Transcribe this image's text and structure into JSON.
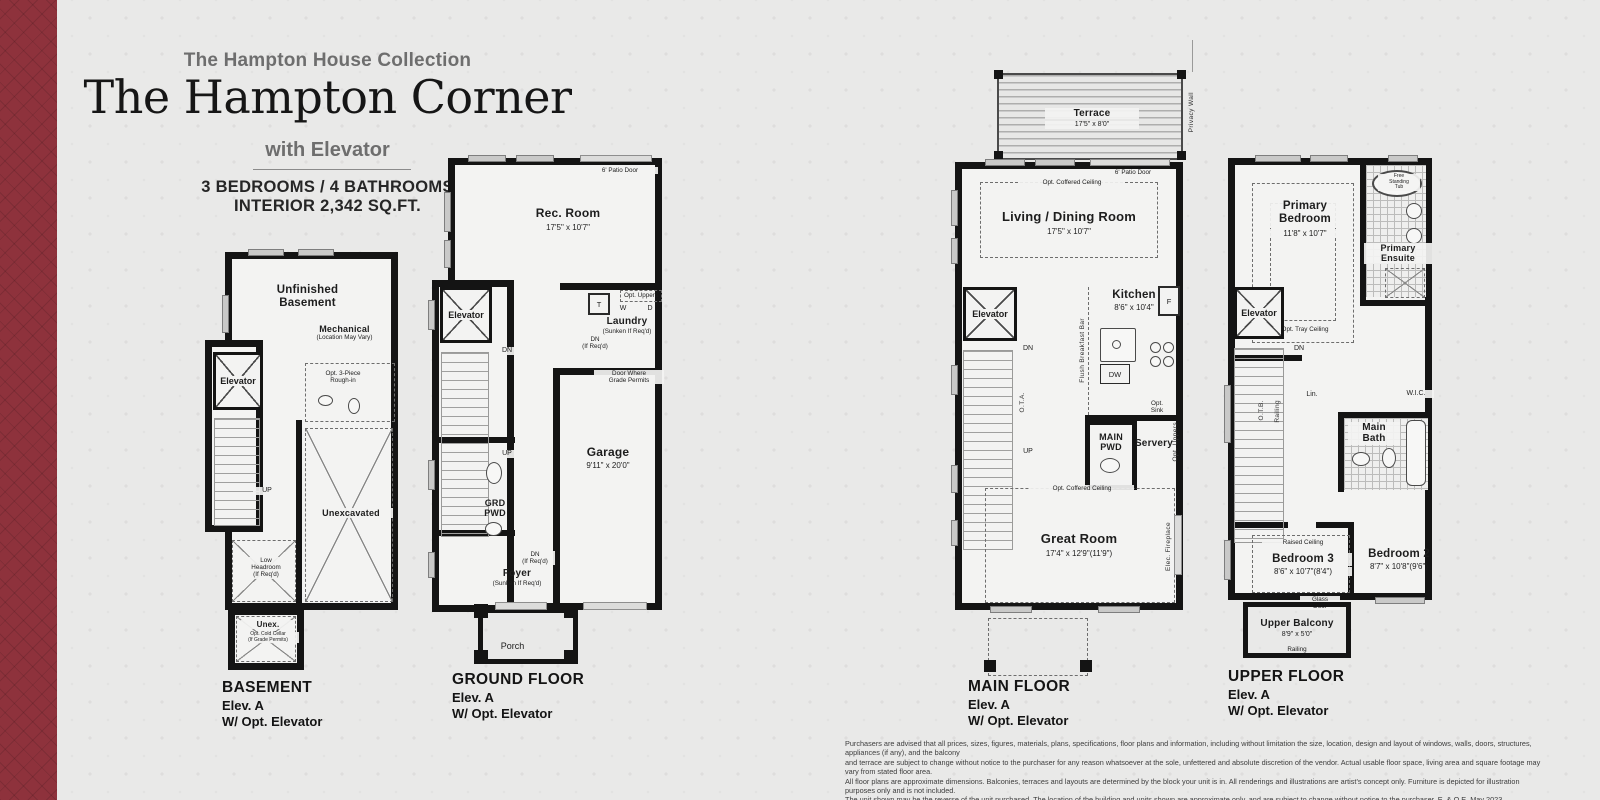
{
  "header": {
    "collection": "The Hampton House Collection",
    "title": "The Hampton Corner",
    "subtitle": "with Elevator",
    "spec1": "3 BEDROOMS / 4 BATHROOMS",
    "spec2": "INTERIOR 2,342 SQ.FT."
  },
  "basement": {
    "title": "BASEMENT",
    "elev": "Elev. A",
    "opt": "W/ Opt. Elevator",
    "unfinished": "Unfinished\nBasement",
    "mechanical": "Mechanical",
    "mechanical_note": "(Location May Vary)",
    "elevator": "Elevator",
    "rough_in": "Opt. 3-Piece\nRough-in",
    "up": "UP",
    "unexcavated": "Unexcavated",
    "low_headroom": "Low\nHeadroom\n(If Req'd)",
    "unex": "Unex.",
    "cold_cellar": "Opt. Cold Cellar\n(If Grade Permits)"
  },
  "ground": {
    "title": "GROUND FLOOR",
    "elev": "Elev. A",
    "opt": "W/ Opt. Elevator",
    "patio_door": "6' Patio Door",
    "rec_room": "Rec. Room",
    "rec_room_dims": "17'5\" x 10'7\"",
    "elevator": "Elevator",
    "dn": "DN",
    "up": "UP",
    "opt_uppers": "Opt. Uppers",
    "t": "T",
    "w": "W",
    "d": "D",
    "laundry": "Laundry",
    "laundry_note": "(Sunken If Req'd)",
    "dn_if_reqd": "DN\n(If Req'd)",
    "door_grade": "Door Where\nGrade Permits",
    "garage": "Garage",
    "garage_dims": "9'11\" x 20'0\"",
    "grd_pwd": "GRD\nPWD",
    "foyer": "Foyer",
    "foyer_note": "(Sunken If Req'd)",
    "foyer_dn": "DN\n(If Req'd)",
    "porch": "Porch"
  },
  "main": {
    "title": "MAIN FLOOR",
    "elev": "Elev. A",
    "opt": "W/ Opt. Elevator",
    "privacy_wall": "Privacy Wall",
    "terrace": "Terrace",
    "terrace_dims": "17'5\" x 8'0\"",
    "patio_door": "6' Patio Door",
    "coffered": "Opt. Coffered Ceiling",
    "living": "Living / Dining Room",
    "living_dims": "17'5\" x 10'7\"",
    "elevator": "Elevator",
    "kitchen": "Kitchen",
    "kitchen_dims": "8'6\" x 10'4\"",
    "breakfast_bar": "Flush Breakfast Bar",
    "fridge": "F",
    "dw": "DW",
    "dn": "DN",
    "ota": "O.T.A.",
    "up": "UP",
    "main_pwd": "MAIN\nPWD",
    "servery": "Servery",
    "opt_sink": "Opt.\nSink",
    "opt_uppers": "Opt. Uppers",
    "coffered2": "Opt. Coffered Ceiling",
    "great_room": "Great Room",
    "great_room_dims": "17'4\" x 12'9\"(11'9\")",
    "fireplace": "Elec. Fireplace"
  },
  "upper": {
    "title": "UPPER FLOOR",
    "elev": "Elev. A",
    "opt": "W/ Opt. Elevator",
    "primary_bedroom": "Primary\nBedroom",
    "primary_bedroom_dims": "11'8\" x 10'7\"",
    "tray_ceiling": "Opt. Tray Ceiling",
    "free_tub": "Free\nStanding\nTub",
    "primary_ensuite": "Primary\nEnsuite",
    "elevator": "Elevator",
    "dn": "DN",
    "otb": "O.T.B.",
    "railing": "Railing",
    "lin": "Lin.",
    "wic": "W.I.C.",
    "main_bath": "Main\nBath",
    "raised_ceiling": "Raised Ceiling",
    "bedroom3": "Bedroom 3",
    "bedroom3_dims": "8'6\" x 10'7\"(8'4\")",
    "glass_door": "Glass\nDoor",
    "bedroom2": "Bedroom 2",
    "bedroom2_dims": "8'7\" x 10'8\"(9'6\")",
    "upper_balcony": "Upper Balcony",
    "upper_balcony_dims": "8'9\" x 5'0\"",
    "balcony_railing": "Railing"
  },
  "disclaimer": {
    "line1": "Purchasers are advised that all prices, sizes, figures, materials, plans, specifications, floor plans and information, including without limitation the size, location, design and layout of windows, walls, doors, structures, appliances (if any), and the balcony",
    "line2": "and terrace are subject to change without notice to the purchaser for any reason whatsoever at the sole, unfettered and absolute discretion of the vendor. Actual usable floor space, living area and square footage may vary from stated floor area.",
    "line3": "All floor plans are approximate dimensions. Balconies, terraces and layouts are determined by the block your unit is in. All renderings and illustrations are artist's concept only. Furniture is depicted for illustration purposes only and is not included.",
    "line4": "The unit shown may be the reverse of the unit purchased. The location of the building and units shown are approximate only, and are subject to change without notice to the purchaser. E. & O.E. May 2023."
  }
}
